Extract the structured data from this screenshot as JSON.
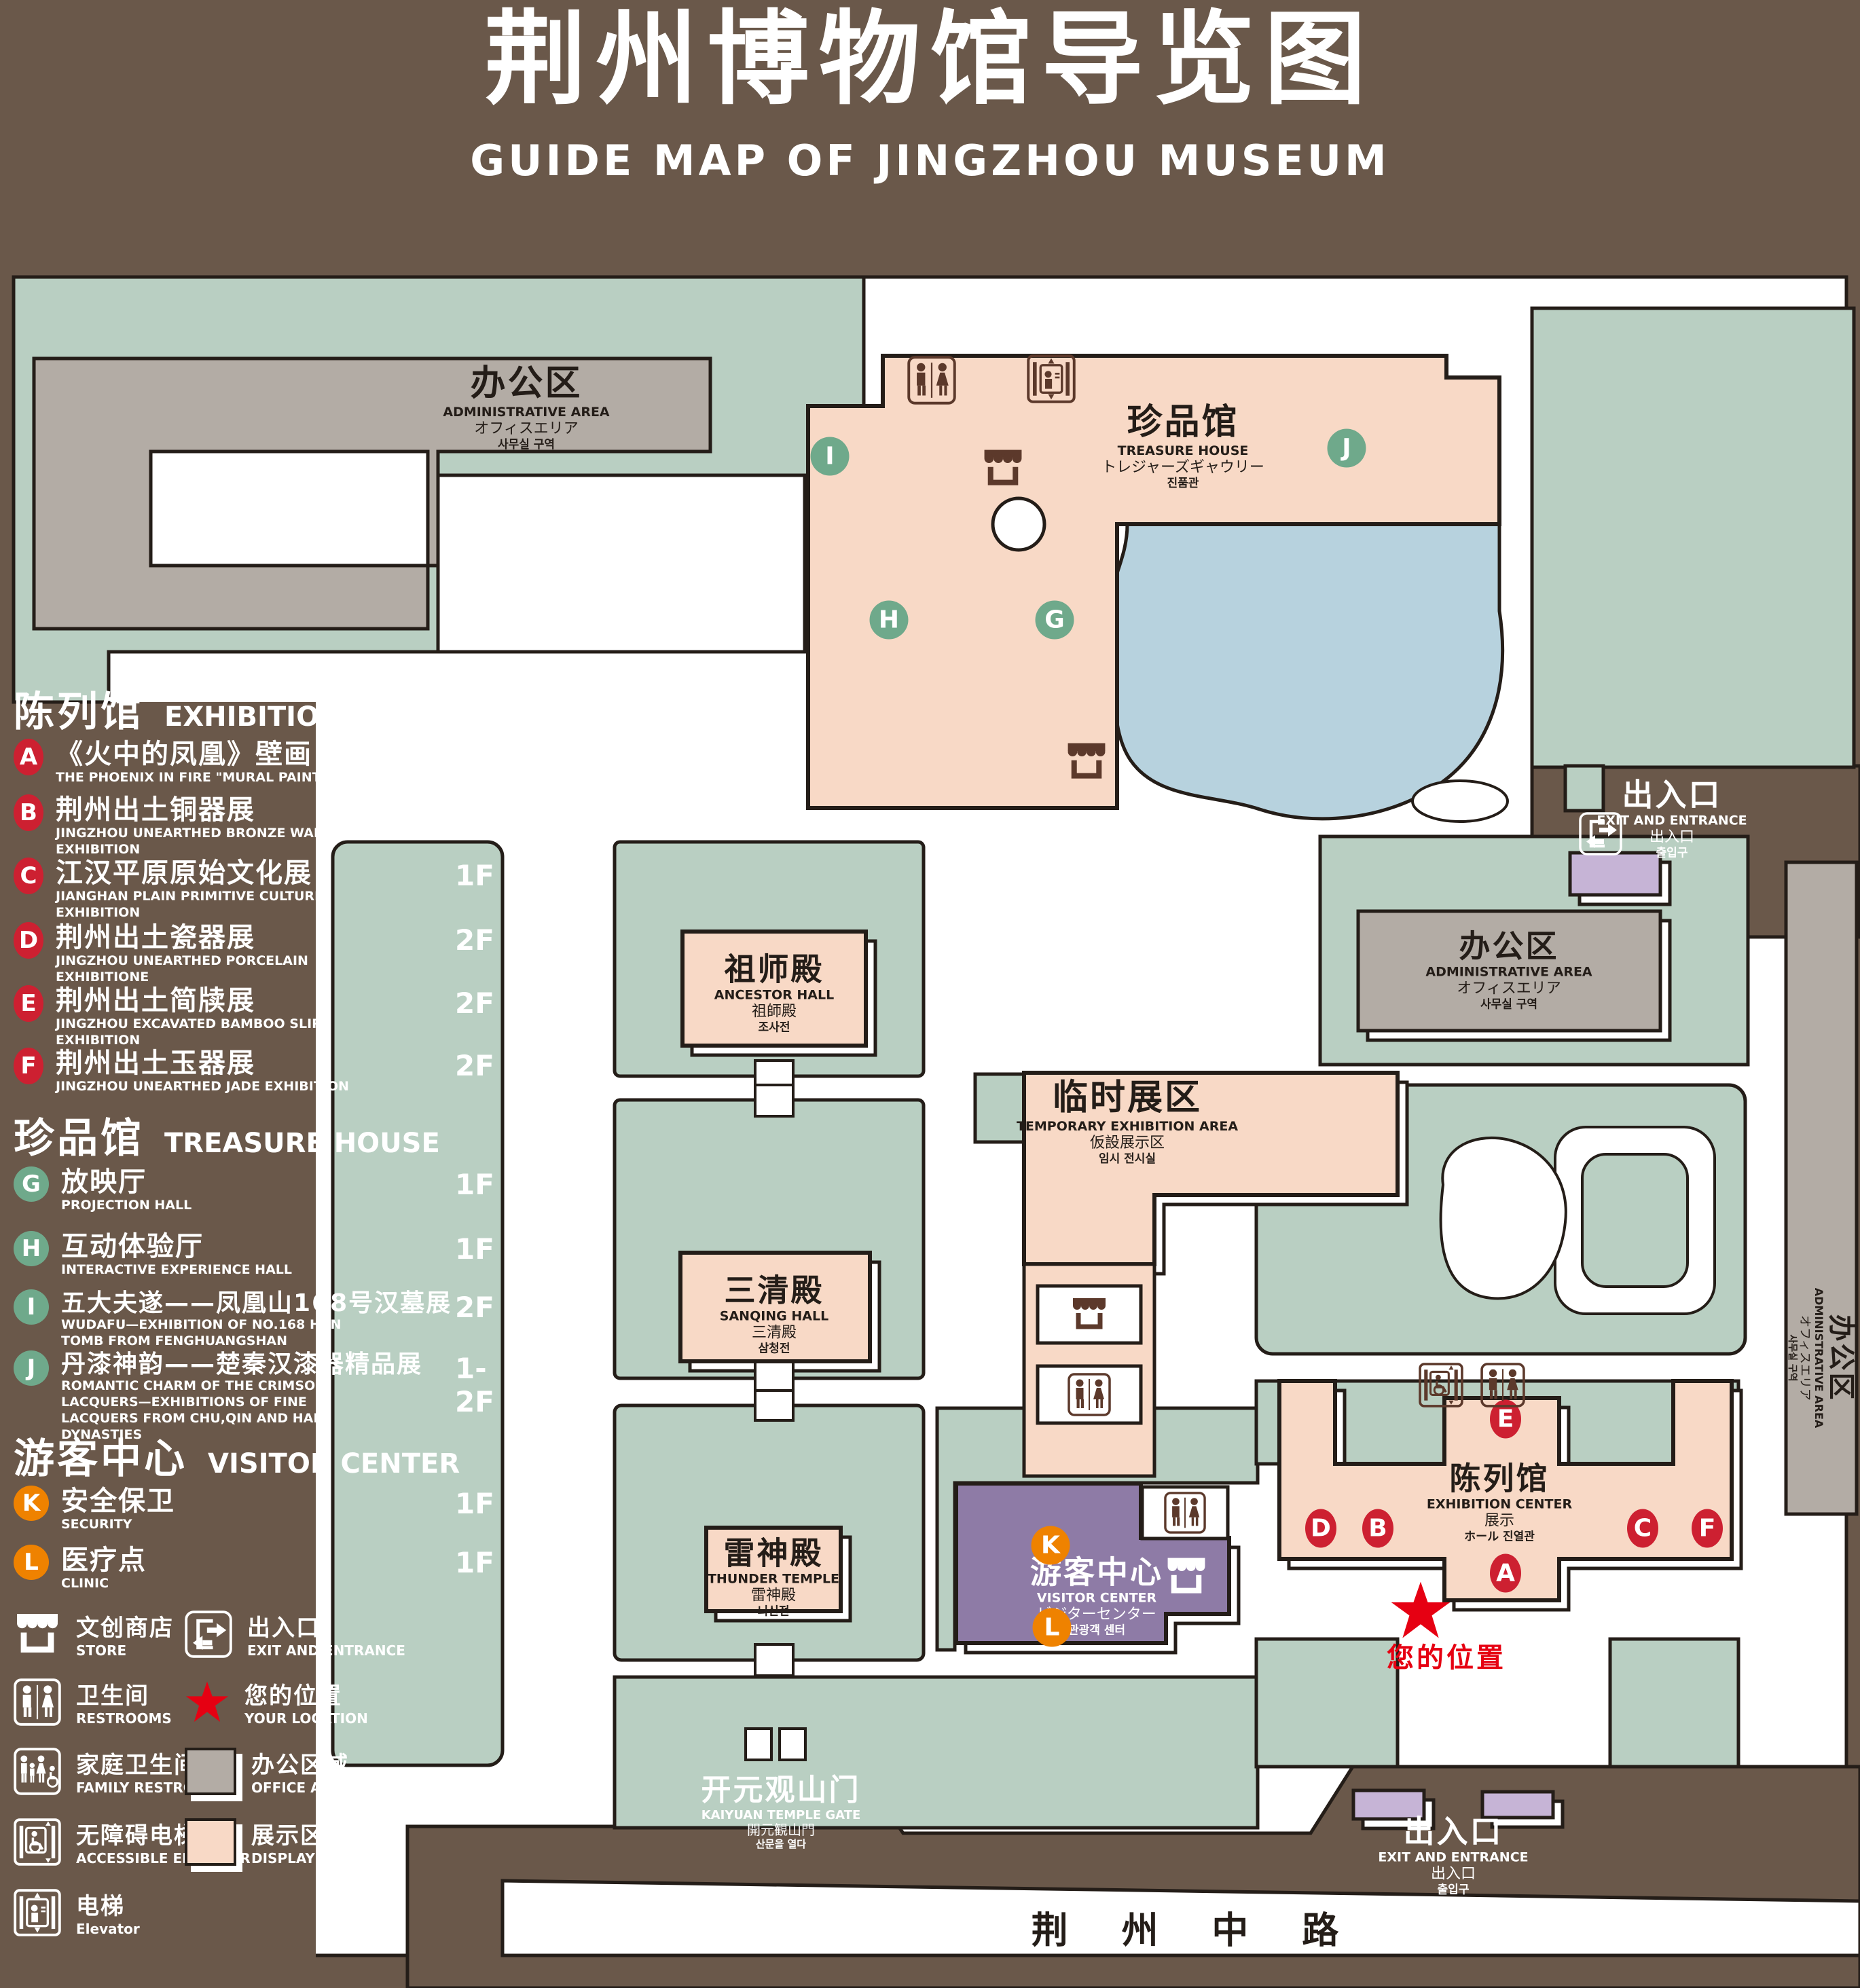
{
  "title": {
    "zh": "荆州博物馆导览图",
    "en": "GUIDE MAP OF JINGZHOU MUSEUM"
  },
  "colors": {
    "background": "#6a584a",
    "lawn_green": "#b9cfc2",
    "display_area_pink": "#f8d9c6",
    "office_area_gray": "#b3aca5",
    "water_blue": "#b7d2de",
    "visitor_purple": "#8e7ba6",
    "gate_purple": "#c6b4d6",
    "marker_red": "#cd2031",
    "marker_green": "#6fa98b",
    "marker_orange": "#ef8200",
    "star_red": "#e60012"
  },
  "icons": {
    "store": "storefront-awning",
    "restroom": "male-female-figures",
    "family_restroom": "family-with-wheelchair",
    "accessible_elevator": "wheelchair-elevator",
    "elevator": "elevator-cab",
    "exit": "door-with-arrows",
    "your_location": "red-star"
  },
  "legend": {
    "sections": [
      {
        "zh": "陈列馆",
        "en": "EXHIBITION CENTER",
        "items": [
          {
            "letter": "A",
            "zh": "《火中的凤凰》壁画",
            "en": "THE PHOENIX IN FIRE \"MURAL PAINTING",
            "floor": "1F"
          },
          {
            "letter": "B",
            "zh": "荆州出土铜器展",
            "en": "JINGZHOU UNEARTHED BRONZE WARE EXHIBITION",
            "floor": "1F"
          },
          {
            "letter": "C",
            "zh": "江汉平原原始文化展",
            "en": "JIANGHAN PLAIN PRIMITIVE CULTURE EXHIBITION",
            "floor": "1F"
          },
          {
            "letter": "D",
            "zh": "荆州出土瓷器展",
            "en": "JINGZHOU UNEARTHED PORCELAIN EXHIBITIONE",
            "floor": "2F"
          },
          {
            "letter": "E",
            "zh": "荆州出土简牍展",
            "en": "JINGZHOU EXCAVATED BAMBOO SLIPS EXHIBITION",
            "floor": "2F"
          },
          {
            "letter": "F",
            "zh": "荆州出土玉器展",
            "en": "JINGZHOU UNEARTHED JADE EXHIBITION",
            "floor": "2F"
          }
        ]
      },
      {
        "zh": "珍品馆",
        "en": "TREASURE HOUSE",
        "items": [
          {
            "letter": "G",
            "zh": "放映厅",
            "en": "PROJECTION HALL",
            "floor": "1F"
          },
          {
            "letter": "H",
            "zh": "互动体验厅",
            "en": "INTERACTIVE EXPERIENCE HALL",
            "floor": "1F"
          },
          {
            "letter": "I",
            "zh": "五大夫遂——凤凰山168号汉墓展",
            "en": "WUDAFU—EXHIBITION OF NO.168 HAN TOMB FROM FENGHUANGSHAN",
            "floor": "2F"
          },
          {
            "letter": "J",
            "zh": "丹漆神韵——楚秦汉漆器精品展",
            "en": "ROMANTIC CHARM OF THE CRIMSON LACQUERS—EXHIBITIONS OF FINE LACQUERS FROM CHU,QIN AND HAN DYNASTIES",
            "floor": "1-2F"
          }
        ]
      },
      {
        "zh": "游客中心",
        "en": "VISITOR CENTER",
        "items": [
          {
            "letter": "K",
            "zh": "安全保卫",
            "en": "SECURITY",
            "floor": "1F"
          },
          {
            "letter": "L",
            "zh": "医疗点",
            "en": "CLINIC",
            "floor": "1F"
          }
        ]
      }
    ],
    "symbols_left": [
      {
        "zh": "文创商店",
        "en": "STORE"
      },
      {
        "zh": "卫生间",
        "en": "RESTROOMS"
      },
      {
        "zh": "家庭卫生间",
        "en": "FAMILY RESTROOMS"
      },
      {
        "zh": "无障碍电梯",
        "en": "ACCESSIBLE ELEVATOR"
      },
      {
        "zh": "电梯",
        "en": "Elevator"
      }
    ],
    "symbols_right": [
      {
        "zh": "出入口",
        "en": "EXIT AND ENTRANCE"
      },
      {
        "zh": "您的位置",
        "en": "YOUR LOCATION"
      },
      {
        "zh": "办公区域",
        "en": "OFFICE AREA"
      },
      {
        "zh": "展示区域",
        "en": "DISPLAY AREA"
      }
    ]
  },
  "map": {
    "labels": {
      "admin": {
        "zh": "办公区",
        "en": "ADMINISTRATIVE AREA",
        "jp": "オフィスエリア",
        "kr": "사무실 구역"
      },
      "treasure": {
        "zh": "珍品馆",
        "en": "TREASURE HOUSE",
        "jp": "トレジャーズギャウリー",
        "kr": "진품관"
      },
      "ancestor": {
        "zh": "祖师殿",
        "en": "ANCESTOR HALL",
        "jp": "祖師殿",
        "kr": "조사전"
      },
      "temporary": {
        "zh": "临时展区",
        "en": "TEMPORARY EXHIBITION AREA",
        "jp": "仮設展示区",
        "kr": "임시 전시실"
      },
      "sanqing": {
        "zh": "三清殿",
        "en": "SANQING HALL",
        "jp": "三清殿",
        "kr": "삼청전"
      },
      "thunder": {
        "zh": "雷神殿",
        "en": "THUNDER TEMPLE",
        "jp": "雷神殿",
        "kr": "뇌신전"
      },
      "visitor": {
        "zh": "游客中心",
        "en": "VISITOR CENTER",
        "jp": "ビジターセンター",
        "kr": "관광객 센터"
      },
      "exhibition": {
        "zh": "陈列馆",
        "en": "EXHIBITION CENTER",
        "jp": "展示",
        "kr": "ホール 진열관"
      },
      "gate": {
        "zh": "开元观山门",
        "en": "KAIYUAN TEMPLE GATE",
        "jp": "開元観山門",
        "kr": "산문을 열다"
      },
      "exit": {
        "zh": "出入口",
        "en": "EXIT AND ENTRANCE",
        "jp": "出入口",
        "kr": "출입구"
      },
      "road": "荆 州 中 路",
      "your_location": "您的位置"
    },
    "markers": [
      {
        "letter": "I"
      },
      {
        "letter": "J"
      },
      {
        "letter": "H"
      },
      {
        "letter": "G"
      },
      {
        "letter": "E"
      },
      {
        "letter": "D"
      },
      {
        "letter": "B"
      },
      {
        "letter": "C"
      },
      {
        "letter": "F"
      },
      {
        "letter": "A"
      },
      {
        "letter": "K"
      },
      {
        "letter": "L"
      }
    ]
  }
}
